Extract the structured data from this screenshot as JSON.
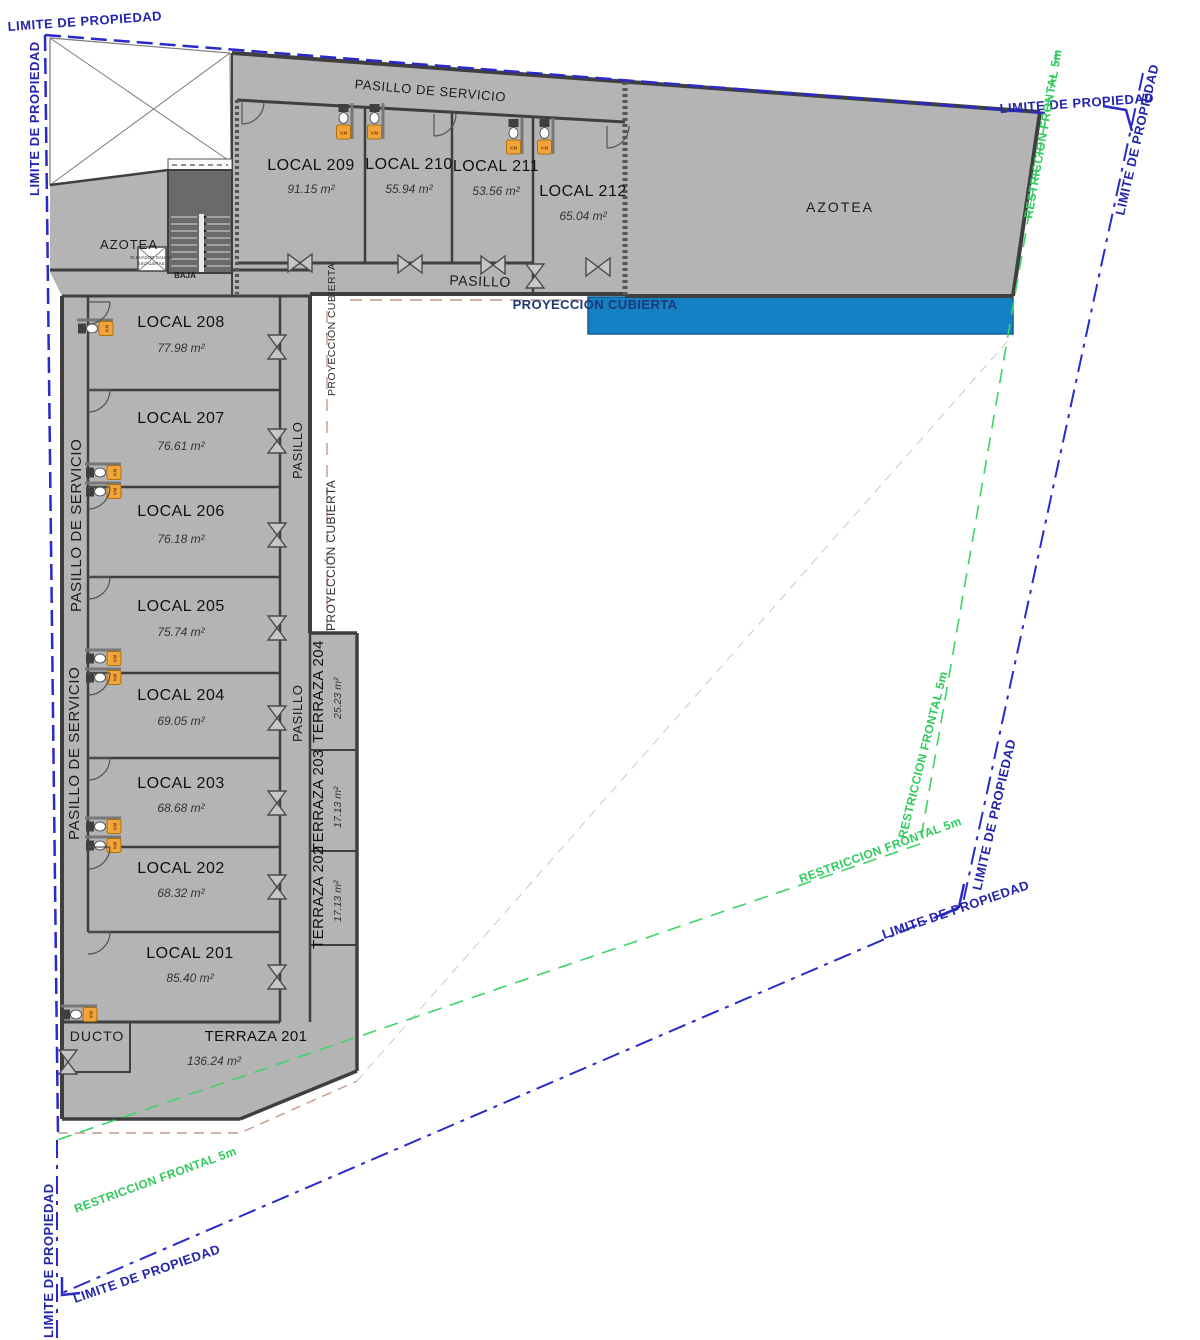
{
  "plan": {
    "locals_left": [
      {
        "name": "LOCAL 208",
        "area": "77.98 m²"
      },
      {
        "name": "LOCAL 207",
        "area": "76.61 m²"
      },
      {
        "name": "LOCAL 206",
        "area": "76.18 m²"
      },
      {
        "name": "LOCAL 205",
        "area": "75.74 m²"
      },
      {
        "name": "LOCAL 204",
        "area": "69.05 m²"
      },
      {
        "name": "LOCAL 203",
        "area": "68.68 m²"
      },
      {
        "name": "LOCAL 202",
        "area": "68.32 m²"
      },
      {
        "name": "LOCAL 201",
        "area": "85.40 m²"
      }
    ],
    "locals_top": [
      {
        "name": "LOCAL 209",
        "area": "91.15 m²"
      },
      {
        "name": "LOCAL 210",
        "area": "55.94 m²"
      },
      {
        "name": "LOCAL 211",
        "area": "53.56 m²"
      },
      {
        "name": "LOCAL 212",
        "area": "65.04 m²"
      }
    ],
    "terrazas": [
      {
        "name": "TERRAZA 204",
        "area": "25.23 m²"
      },
      {
        "name": "TERRAZA 203",
        "area": "17.13 m²"
      },
      {
        "name": "TERRAZA 202",
        "area": "17.13 m²"
      },
      {
        "name": "TERRAZA 201",
        "area": "136.24 m²"
      }
    ],
    "corridors": {
      "pasillo_servicio": "PASILLO DE SERVICIO",
      "pasillo": "PASILLO"
    },
    "areas_labels": {
      "azotea": "AZOTEA",
      "proyeccion_cubierta": "PROYECCIÓN CUBIERTA",
      "ducto": "DUCTO",
      "baja": "BAJA",
      "elevador_line1": "ELEVADOR SALIDA",
      "elevador_line2": "ESCALERAS",
      "vm": "V.M"
    },
    "boundaries": {
      "limite": "LIMITE DE PROPIEDAD",
      "restriccion": "RESTRICCION FRONTAL 5m"
    },
    "colors": {
      "building": "#b4b4b4",
      "walls": "#3f3f3f",
      "cover_blue": "#1581c5",
      "property_line": "#2a2ac8",
      "property_text": "#2424ad",
      "restriction_green": "#3fd467",
      "terrace_dash": "#c49a8a",
      "fixture_orange": "#f2a33c"
    }
  }
}
